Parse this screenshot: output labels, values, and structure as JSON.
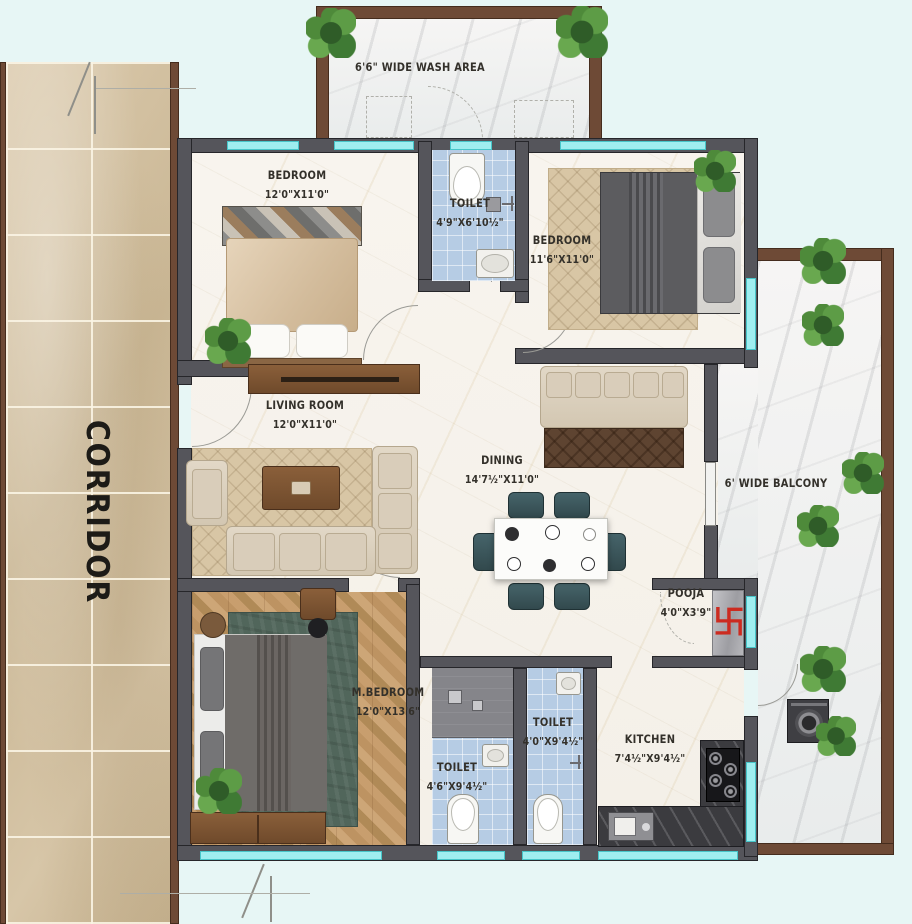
{
  "plan_title": "3 BHK Apartment Floor Plan",
  "colors": {
    "wall": "#55555b",
    "outer_wall_brown": "#6e4a36",
    "window_glass": "#9feef0",
    "toilet_tile": "#b6cce4",
    "corridor_tile": "#d3c1a1",
    "background": "#e7f6f5",
    "pooja_symbol_red": "#cc2b20"
  },
  "corridor": {
    "label": "CORRIDOR"
  },
  "rooms": {
    "wash_area": {
      "label": "6'6\" WIDE WASH AREA"
    },
    "bedroom_top_left": {
      "name": "BEDROOM",
      "dims": "12'0\"X11'0\""
    },
    "toilet_top": {
      "name": "TOILET",
      "dims": "4'9\"X6'10½\""
    },
    "bedroom_top_right": {
      "name": "BEDROOM",
      "dims": "11'6\"X11'0\""
    },
    "living_room": {
      "name": "LIVING ROOM",
      "dims": "12'0\"X11'0\""
    },
    "dining": {
      "name": "DINING",
      "dims": "14'7½\"X11'0\""
    },
    "balcony": {
      "label": "6' WIDE BALCONY"
    },
    "pooja": {
      "name": "POOJA",
      "dims": "4'0\"X3'9\"",
      "symbol": "卐"
    },
    "master_bedroom": {
      "name": "M.BEDROOM",
      "dims": "12'0\"X13'6\""
    },
    "toilet_bottom_left": {
      "name": "TOILET",
      "dims": "4'6\"X9'4½\""
    },
    "toilet_bottom_mid": {
      "name": "TOILET",
      "dims": "4'0\"X9'4½\""
    },
    "kitchen": {
      "name": "KITCHEN",
      "dims": "7'4½\"X9'4½\""
    }
  }
}
